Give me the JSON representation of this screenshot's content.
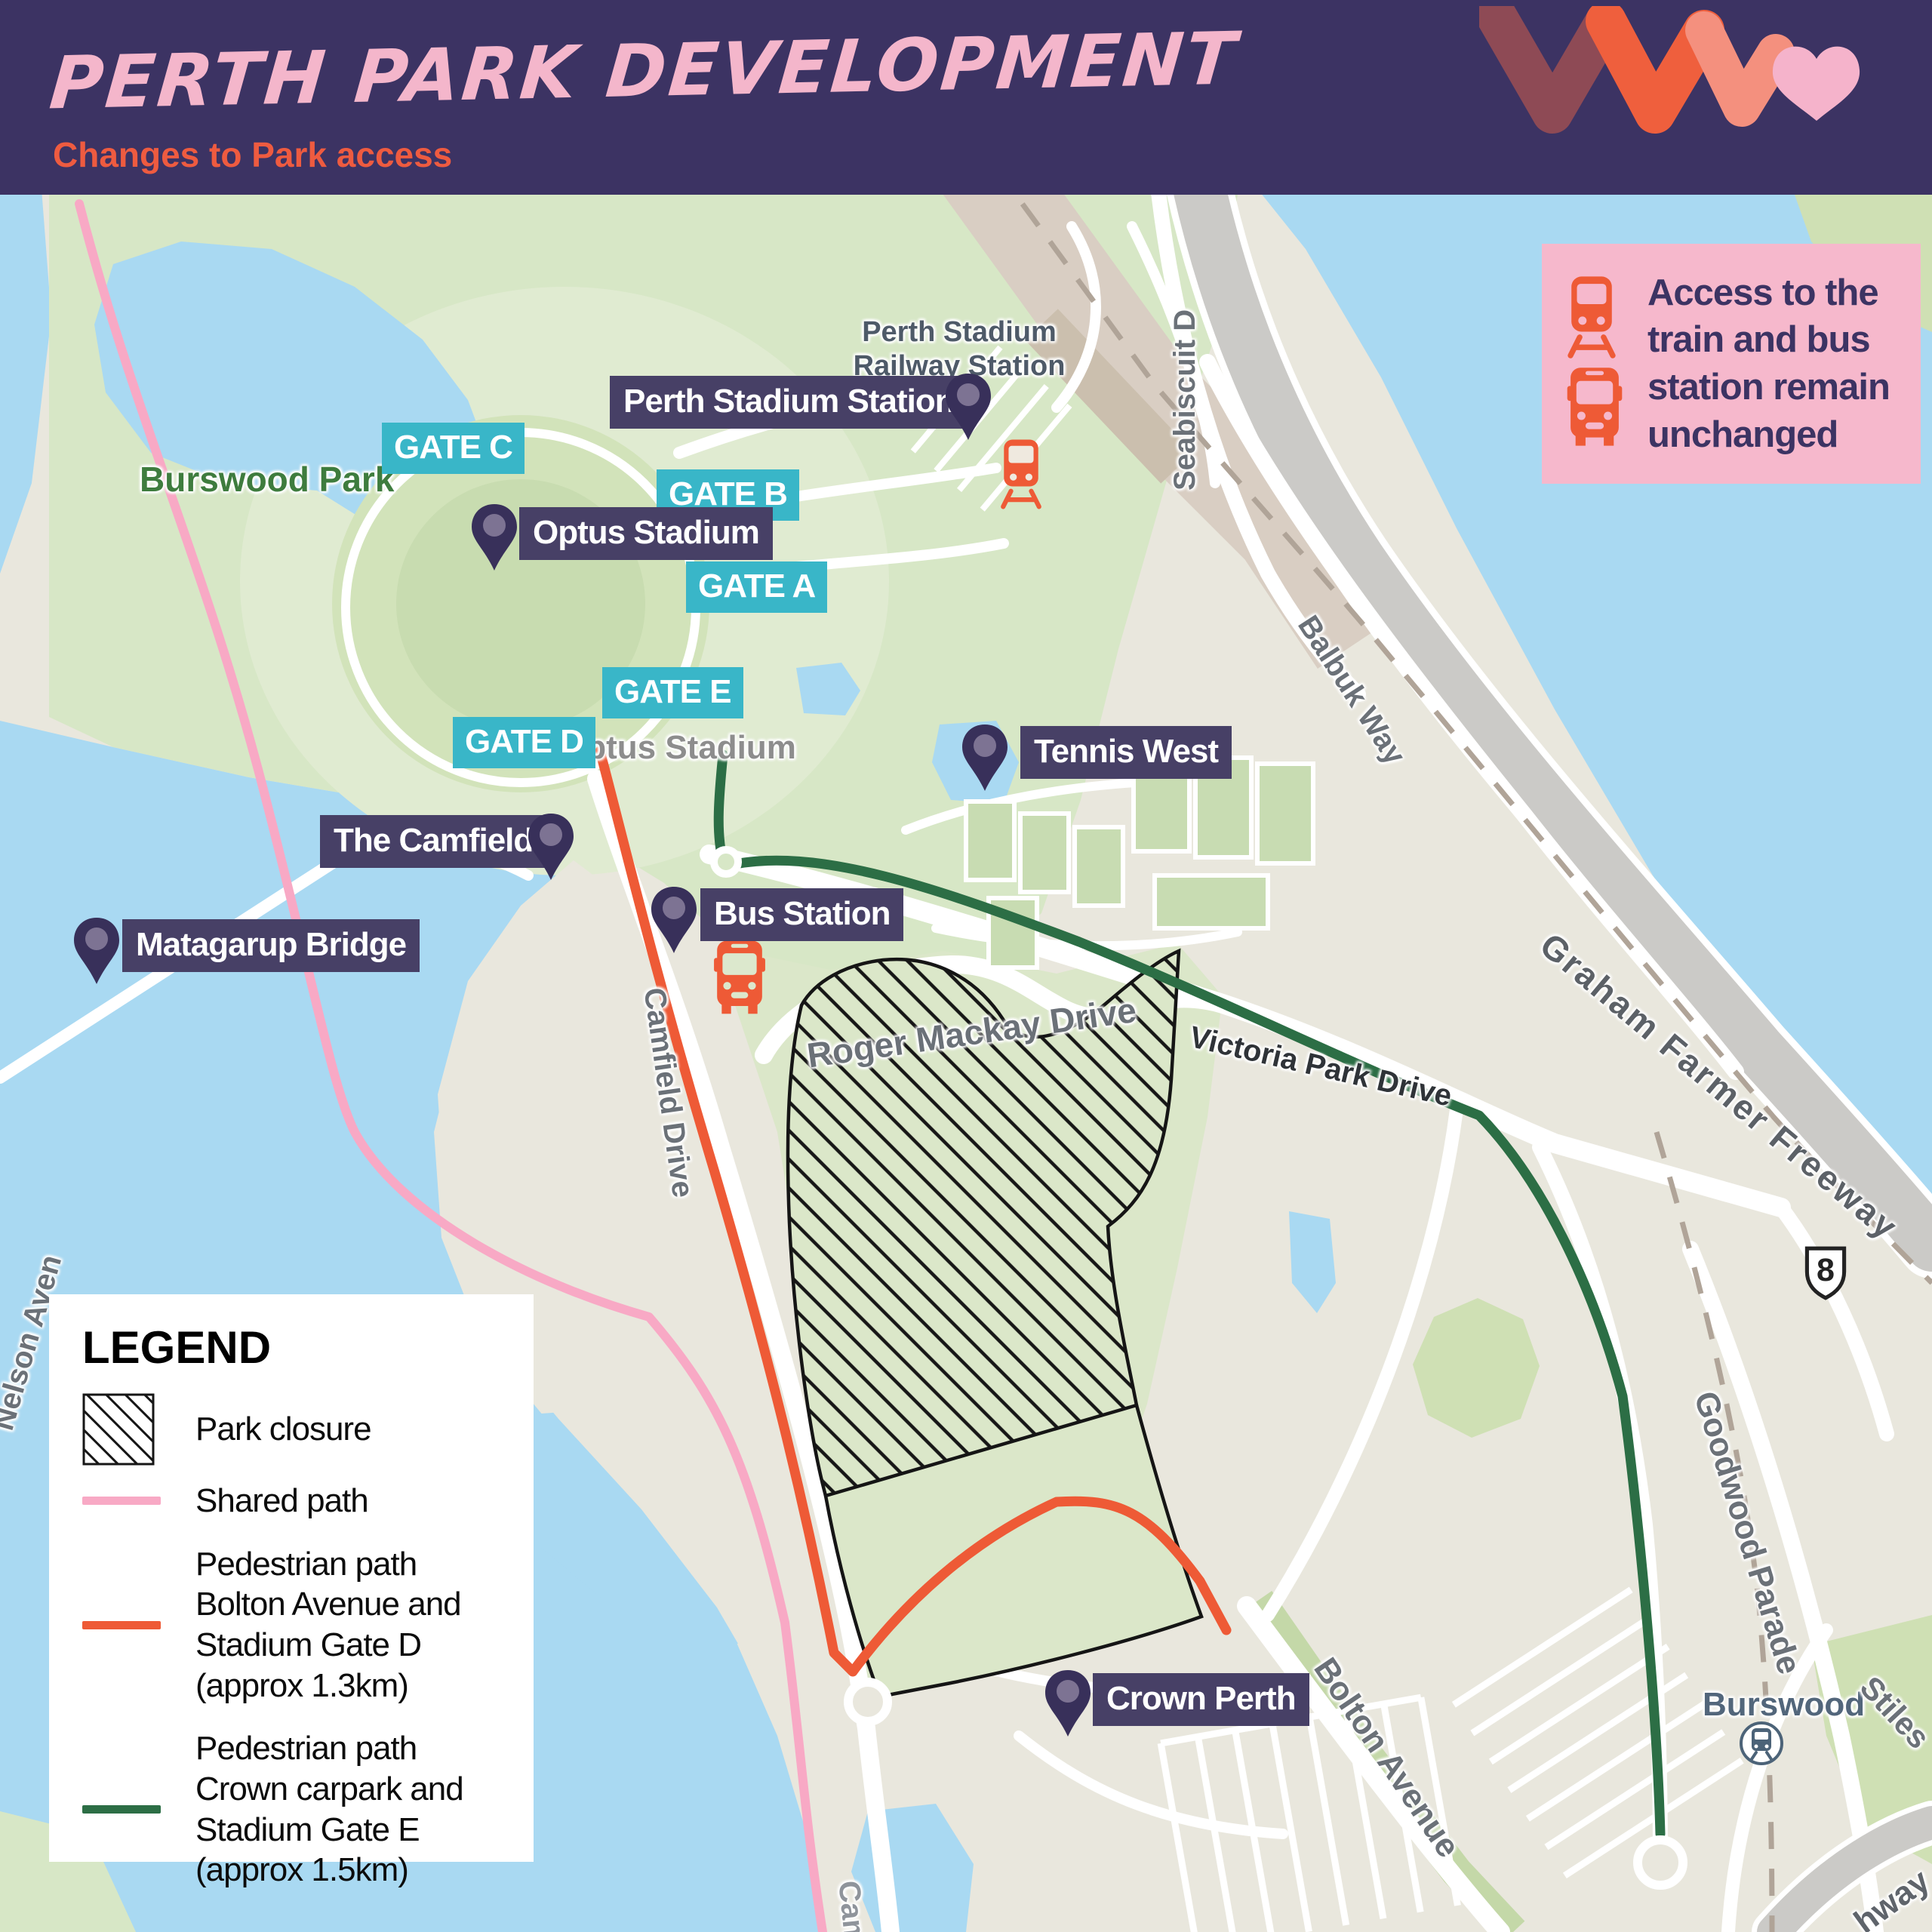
{
  "header": {
    "title": "PERTH PARK DEVELOPMENT",
    "subtitle": "Changes to Park access"
  },
  "callout": {
    "text": "Access to the train and bus station remain unchanged"
  },
  "legend": {
    "title": "LEGEND",
    "items": [
      {
        "id": "park-closure",
        "label": "Park closure",
        "swatch": "hatch"
      },
      {
        "id": "shared-path",
        "label": "Shared path",
        "swatch": "line",
        "color": "#f8a9c5"
      },
      {
        "id": "pedestrian-path-gate-d",
        "label": "Pedestrian path Bolton Avenue and Stadium Gate D (approx 1.3km)",
        "swatch": "line",
        "color": "#ee5a36"
      },
      {
        "id": "pedestrian-path-gate-e",
        "label": "Pedestrian path Crown carpark and Stadium Gate E (approx 1.5km)",
        "swatch": "line",
        "color": "#2c6e45"
      }
    ]
  },
  "map": {
    "pins": [
      {
        "id": "perth-stadium-station",
        "label": "Perth Stadium Station"
      },
      {
        "id": "optus-stadium",
        "label": "Optus Stadium"
      },
      {
        "id": "tennis-west",
        "label": "Tennis West"
      },
      {
        "id": "the-camfield",
        "label": "The Camfield"
      },
      {
        "id": "matagarup-bridge",
        "label": "Matagarup Bridge"
      },
      {
        "id": "bus-station",
        "label": "Bus Station"
      },
      {
        "id": "crown-perth",
        "label": "Crown Perth"
      }
    ],
    "gates": [
      {
        "label": "GATE C"
      },
      {
        "label": "GATE B"
      },
      {
        "label": "GATE A"
      },
      {
        "label": "GATE E"
      },
      {
        "label": "GATE D"
      }
    ],
    "road_labels": [
      {
        "id": "seabiscuit-drive",
        "text": "Seabiscuit D"
      },
      {
        "id": "balbuk-way",
        "text": "Balbuk Way"
      },
      {
        "id": "graham-farmer-freeway",
        "text": "Graham Farmer Freeway"
      },
      {
        "id": "victoria-park-drive",
        "text": "Victoria Park Drive"
      },
      {
        "id": "roger-mackay-drive",
        "text": "Roger Mackay Drive"
      },
      {
        "id": "camfield-drive",
        "text": "Camfield Drive"
      },
      {
        "id": "bolton-avenue",
        "text": "Bolton Avenue"
      },
      {
        "id": "goodwood-parade",
        "text": "Goodwood Parade"
      },
      {
        "id": "stiles-street",
        "text": "Stiles"
      },
      {
        "id": "great-eastern-highway",
        "text": "hway"
      },
      {
        "id": "camfield-drive-south",
        "text": "Camfi"
      },
      {
        "id": "nelson-avenue",
        "text": "Nelson Aven"
      }
    ],
    "area_labels": [
      {
        "id": "burswood-park",
        "text": "Burswood Park"
      },
      {
        "id": "perth-stadium-railway-station",
        "text": "Perth Stadium Railway Station"
      },
      {
        "id": "optus-stadium-area",
        "text": "Optus Stadium"
      },
      {
        "id": "burswood-suburb",
        "text": "Burswood"
      }
    ],
    "route_shield": "8",
    "colors": {
      "header_bg": "#3c3363",
      "title_pink": "#f4b6cb",
      "subtitle_orange": "#ee5b40",
      "label_bg": "#474066",
      "gate_teal": "#39b6c8",
      "pin_dark": "#38305a",
      "pin_inner": "#7d7393",
      "callout_bg": "#f6b8cc",
      "icon_orange": "#ee5a36",
      "water": "#a9d9f2",
      "park_green": "#d7e7c6",
      "shared_path_pink": "#f8a9c5",
      "path_orange": "#ee5a36",
      "path_green": "#2c6e45"
    }
  }
}
